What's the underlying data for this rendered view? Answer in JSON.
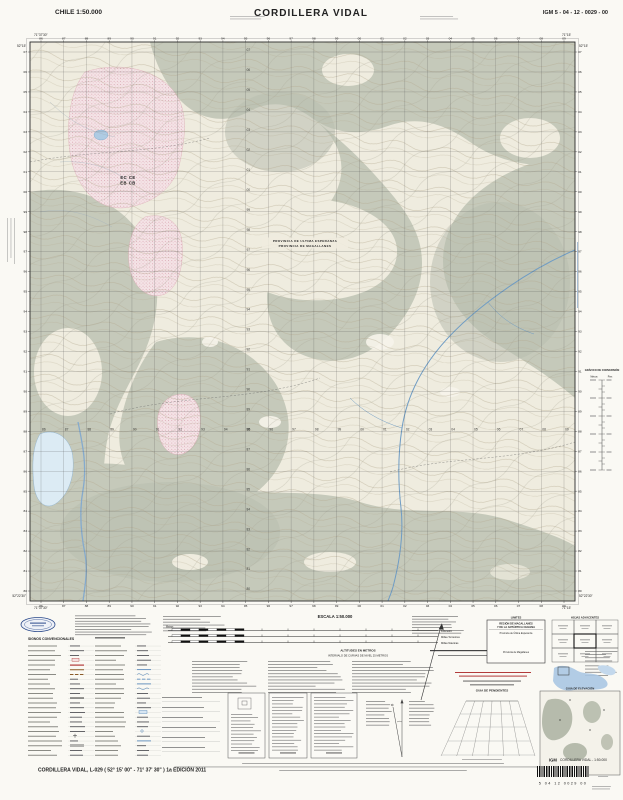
{
  "palette": {
    "paper": "#faf9f4",
    "map_base": "#efecdf",
    "vegetation_gray": "#c5c9ba",
    "wetland_pink": "#f4e3e6",
    "water_blue": "#6f9cc4",
    "accent_red": "#b23b3b",
    "navy": "#2b4a8b"
  },
  "header": {
    "country_scale": "CHILE  1:50.000",
    "title": "CORDILLERA VIDAL",
    "sheet_code": "IGM 5 - 04 - 12 - 0029 - 00"
  },
  "map": {
    "grid": {
      "col_labels": [
        "86",
        "87",
        "88",
        "89",
        "90",
        "91",
        "92",
        "93",
        "94",
        "95",
        "96",
        "97",
        "98",
        "99",
        "00",
        "01",
        "02",
        "03",
        "04",
        "05",
        "06",
        "07",
        "08",
        "09"
      ],
      "row_labels": [
        "07",
        "06",
        "05",
        "04",
        "03",
        "02",
        "01",
        "00",
        "99",
        "98",
        "97",
        "96",
        "95",
        "94",
        "93",
        "92",
        "91",
        "90",
        "89",
        "88",
        "87",
        "86",
        "85",
        "84",
        "83",
        "82",
        "81",
        "80"
      ]
    },
    "corners": {
      "top_left_lon": "71°37'30\"",
      "top_left_lat": "52°15'",
      "bottom_left_lat": "52°22'30\"",
      "bottom_left_lon": "71°37'30\"",
      "top_right_lon": "71°15'",
      "top_right_lat": "52°15'",
      "bottom_right_lat": "52°22'30\"",
      "bottom_right_lon": "71°15'"
    },
    "labels": {
      "province_boundary_top": "PROVINCIA DE ULTIMA ESPERANZA",
      "province_boundary_bottom": "PROVINCIA DE MAGALLANES",
      "zone_code_top": "EC CE",
      "zone_code_bottom": "EB CB"
    }
  },
  "right_margin": {
    "conversion_title": "GRÁFICO DE CONVERSIÓN",
    "col_left": "Metros",
    "col_right": "Pies"
  },
  "legend": {
    "title": "SIGNOS CONVENCIONALES"
  },
  "scale_block": {
    "title": "ESCALA 1:50.000",
    "meters_label": "Metros",
    "bar_labels": [
      "Kilómetro",
      "Millas Terrestres",
      "Millas Náuticas"
    ],
    "altitudes_heading": "ALTITUDES EN METROS",
    "interval_line": "INTERVALO DE CURVAS DE NIVEL 25 METROS"
  },
  "limits_box": {
    "title": "LIMITES",
    "region_line1": "REGIÓN DE MAGALLANES",
    "region_line2": "Y DE LA ANTÁRTICA CHILENA",
    "province_top": "Provincia de Última Esperanza",
    "province_bottom": "Provincia de Magallanes"
  },
  "adjacent_sheets": {
    "title": "HOJAS ADYACENTES"
  },
  "guides": {
    "slope_guide_title": "GUIA DE PENDIENTES",
    "elevation_guide_title": "GUIA DE ELEVACIÓN"
  },
  "footer": {
    "title_line": "CORDILLERA VIDAL, L-029 ( 52° 15' 00\" - 71° 37' 30\" )  1a EDICIÓN 2011",
    "publisher": "IGM",
    "sheet_name_scale": "CORDILLERA VIDAL - 1:50.000",
    "barcode_digits": "5 04 12 0029 00"
  }
}
